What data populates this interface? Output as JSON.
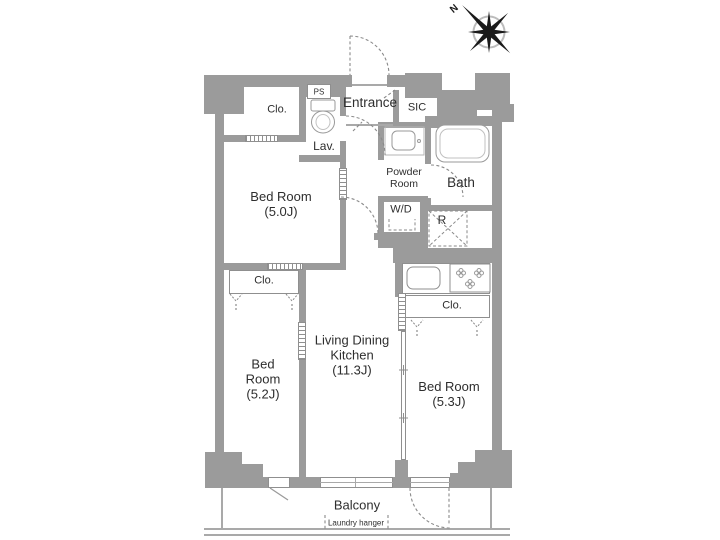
{
  "compass": {
    "north": "N"
  },
  "colors": {
    "wall": "#9b9b9b",
    "thin_line": "#a9a9a9",
    "dash": "#8a8a8a",
    "text": "#2e2e2e"
  },
  "rooms": {
    "entrance": {
      "label": "Entrance"
    },
    "sic": {
      "label": "SIC"
    },
    "ps": {
      "label": "PS"
    },
    "lavatory": {
      "label": "Lav."
    },
    "powder_room": {
      "line1": "Powder",
      "line2": "Room"
    },
    "bath": {
      "label": "Bath"
    },
    "washer_dryer": {
      "label": "W/D"
    },
    "refrigerator": {
      "label": "R"
    },
    "closet_top": {
      "label": "Clo."
    },
    "closet_left": {
      "label": "Clo."
    },
    "closet_right": {
      "label": "Clo."
    },
    "bedroom_50": {
      "line1": "Bed Room",
      "size": "(5.0J)"
    },
    "bedroom_52": {
      "line1": "Bed",
      "line2": "Room",
      "size": "(5.2J)"
    },
    "bedroom_53": {
      "line1": "Bed Room",
      "size": "(5.3J)"
    },
    "ldk": {
      "line1": "Living Dining",
      "line2": "Kitchen",
      "size": "(11.3J)"
    },
    "balcony": {
      "label": "Balcony",
      "laundry": "Laundry hanger"
    }
  }
}
